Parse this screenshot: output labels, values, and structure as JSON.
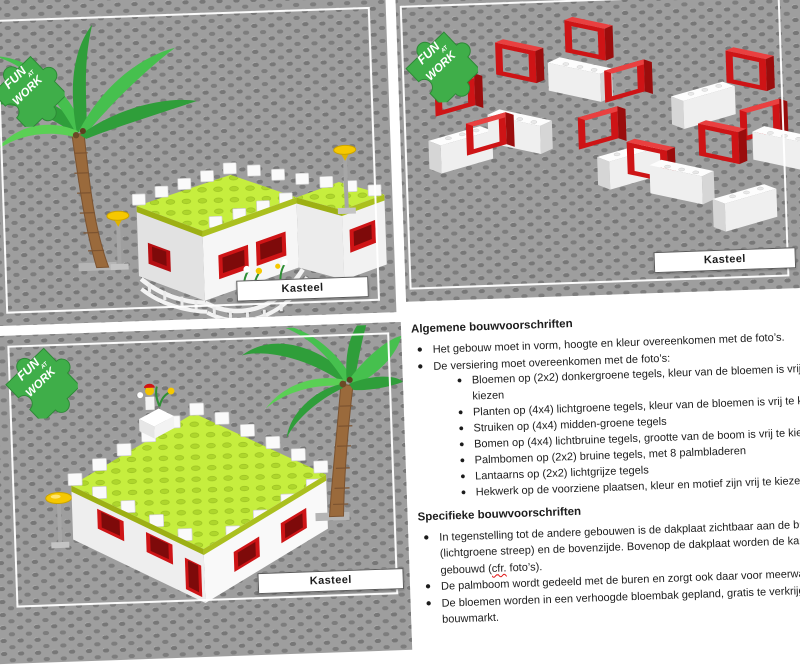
{
  "document": {
    "page_type": "LEGO bouwvoorschriften blad",
    "subject": "Kasteel"
  },
  "photos": [
    {
      "caption": "Kasteel"
    },
    {
      "caption": "Kasteel"
    },
    {
      "caption": "Kasteel"
    }
  ],
  "logos": {
    "fun_at_work": {
      "word1": "FUN",
      "word2": "AT",
      "word3": "WORK",
      "color": "#3fae49"
    },
    "brick_city": {
      "label": "BRICK CITY",
      "brick_color": "#c01010",
      "corner_color": "#2f8f3a"
    }
  },
  "instructions": {
    "general": {
      "heading": "Algemene bouwvoorschriften",
      "b1": "Het gebouw moet in vorm, hoogte en kleur overeenkomen met de foto’s.",
      "b2": "De versiering moet overeenkomen met de foto’s:",
      "sub": [
        "Bloemen op (2x2) donkergroene tegels, kleur van de bloemen is vrij te kiezen",
        "Planten op (4x4) lichtgroene tegels, kleur van de bloemen is vrij te kiezen",
        "Struiken op (4x4) midden-groene tegels",
        "Bomen op (4x4) lichtbruine tegels, grootte van de boom is vrij te kiezen",
        "Palmbomen op (2x2) bruine tegels, met 8 palmbladeren",
        "Lantaarns op (2x2) lichtgrijze tegels",
        "Hekwerk op de voorziene plaatsen, kleur en motief zijn vrij te kiezen"
      ]
    },
    "specific": {
      "heading": "Specifieke bouwvoorschriften",
      "b1_part1": "In tegenstelling tot de andere gebouwen is de dakplaat zichtbaar aan de buitenkant (lichtgroene streep) en de bovenzijde. Bovenop de dakplaat worden de kantelen gebouwd (",
      "b1_misspelled": "cfr.",
      "b1_part2": " foto’s).",
      "b2": "De palmboom wordt gedeeld met de buren en zorgt ook daar voor meerwaarde.",
      "b3": "De bloemen worden in een verhoogde bloembak gepland, gratis te verkrijgen in de bouwmarkt."
    }
  },
  "colors": {
    "baseplate_gray": "#9e9e9e",
    "stud_shadow": "#777777",
    "brick_white": "#f6f6f6",
    "roof_lime": "#c6ee3e",
    "stripe_olive": "#abc01f",
    "window_red": "#ce1416",
    "palm_green": "#3aa93f",
    "trunk_brown": "#9a6a3c",
    "lamp_yellow": "#f6c800",
    "logo_green": "#3fae49",
    "text": "#1c1c1c"
  }
}
